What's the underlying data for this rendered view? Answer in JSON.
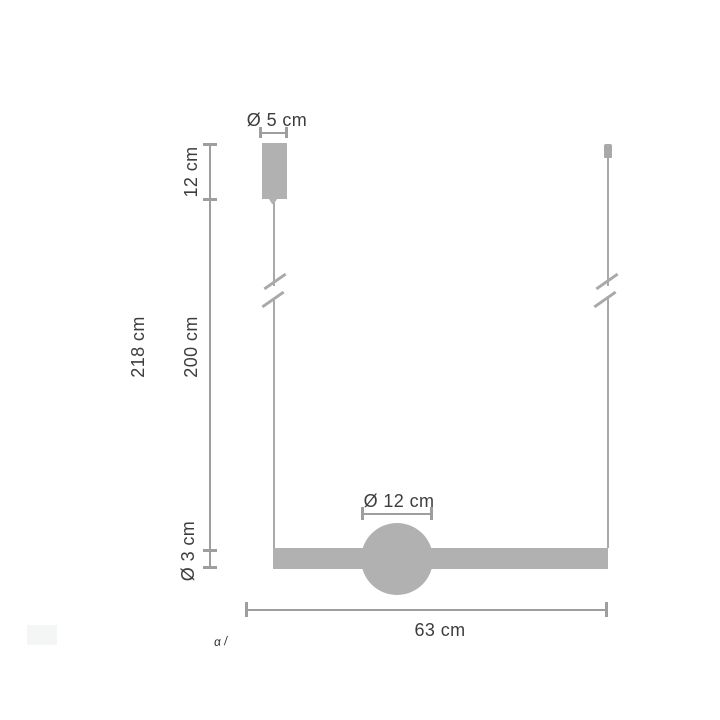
{
  "diagram": {
    "labels": {
      "canopy_diameter": "Ø 5 cm",
      "canopy_height": "12 cm",
      "total_height": "218 cm",
      "cable_length": "200 cm",
      "bar_diameter": "Ø 3 cm",
      "sphere_diameter": "Ø 12 cm",
      "bar_width": "63 cm"
    },
    "watermark_fragment": "α /",
    "colors": {
      "background": "#ffffff",
      "fixture_fill": "#b1b1b1",
      "cable": "#a9a9a9",
      "dimension_line": "#9e9e9e",
      "text": "#3d3d3d",
      "faint_box": "#f4f5f5"
    }
  }
}
